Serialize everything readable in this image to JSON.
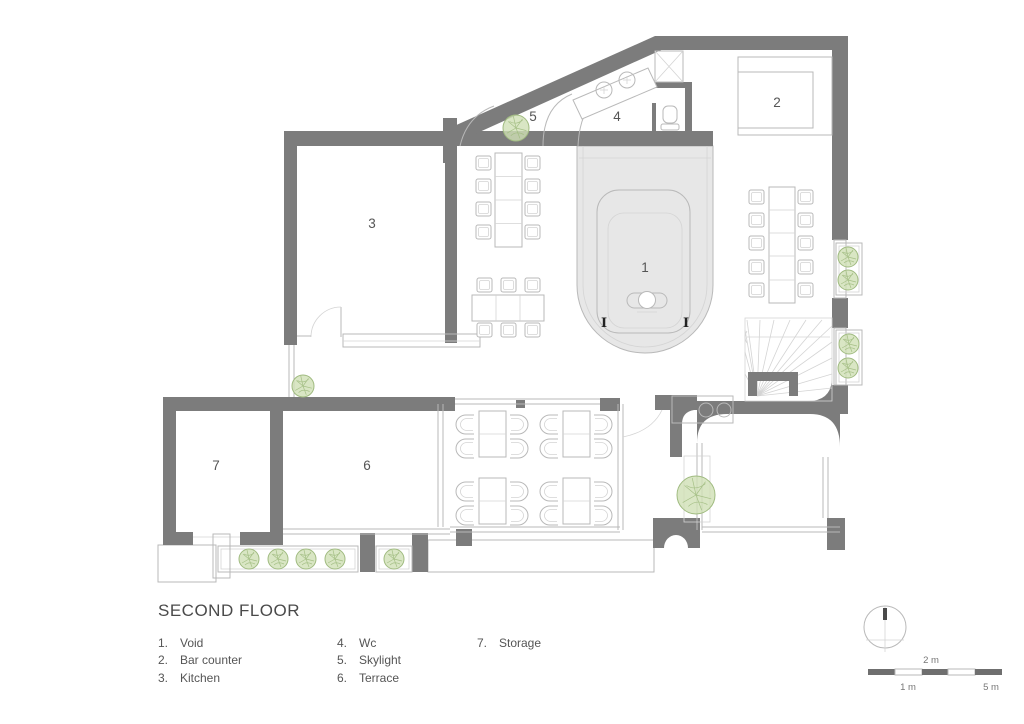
{
  "title": "SECOND FLOOR",
  "rooms": [
    {
      "id": "1",
      "label": "1.",
      "name": "Void"
    },
    {
      "id": "2",
      "label": "2.",
      "name": "Bar counter"
    },
    {
      "id": "3",
      "label": "3.",
      "name": "Kitchen"
    },
    {
      "id": "4",
      "label": "4.",
      "name": "Wc"
    },
    {
      "id": "5",
      "label": "5.",
      "name": "Skylight"
    },
    {
      "id": "6",
      "label": "6.",
      "name": "Terrace"
    },
    {
      "id": "7",
      "label": "7.",
      "name": "Storage"
    }
  ],
  "section_markers": {
    "glyph": "I"
  },
  "scale_bar": {
    "label_1": "1 m",
    "label_2": "2 m",
    "label_5": "5 m"
  },
  "colors": {
    "wall": "#7c7c7c",
    "line": "#b9b9b9",
    "line-light": "#d4d4d4",
    "void-fill": "#e7e7e7",
    "tree-fill": "#cfe0b5",
    "tree-stroke": "#a0bb80",
    "text": "#555555",
    "text-light": "#777777",
    "paper": "#ffffff"
  }
}
